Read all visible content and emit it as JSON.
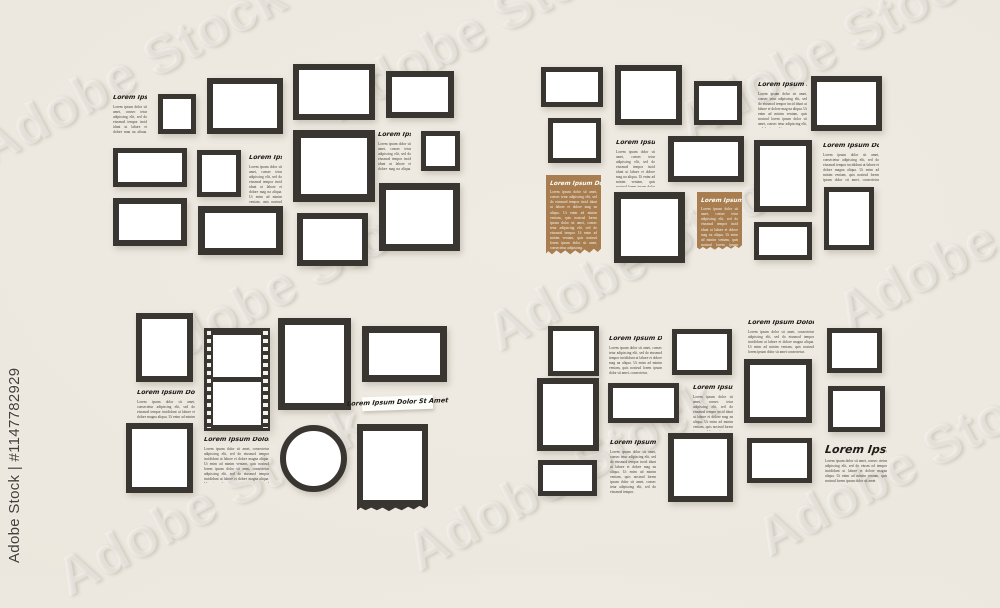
{
  "watermark": {
    "tile_text": "Adobe Stock",
    "side_text": "Adobe Stock | #1147782929"
  },
  "colors": {
    "background": "#ece8df",
    "frame_border": "#393531",
    "frame_fill": "#ffffff",
    "paper_brown": "#a87e50",
    "title_text": "#1f1c18",
    "body_text": "#46423b"
  },
  "captions": {
    "tl1": {
      "title": "Lorem Ipsum Dolor",
      "body": "Lorem ipsum dolor sit amet, consec tetur adipiscing elit, sed do eiusmod tempor incid idunt ut labore et dolore mag na aliqua. Ut enim ad minim veniam, quis nostrud lorem ipsum dolor sit amet, consec tetur adipiscing elit, sed do eiusmod tempor."
    },
    "tl2": {
      "title": "Lorem Ipsum Dolor",
      "body": "Lorem ipsum dolor sit amet, consec tetur adipiscing elit, sed do eiusmod tempor incid idunt ut labore et dolore mag na aliqua. Ut enim ad minim veniam, quis nostrud lorem ipsum dolor sit amet, consec tetur adipiscing elit, sed do eiusmod tempor."
    },
    "tl3": {
      "title": "Lorem Ipsum Dolor",
      "body": "Lorem ipsum dolor sit amet, consec tetur adipiscing elit, sed do eiusmod tempor incid idunt ut labore et dolore mag na aliqua. Ut enim ad minim veniam, quis nostrud lorem ipsum dolor sit amet, consec tetur adipiscing elit, sed do."
    },
    "tr1": {
      "title": "Lorem Ipsum Dolor",
      "body": "Lorem ipsum dolor sit amet, consec tetur adipiscing elit, sed do eiusmod tempor incid idunt ut labore et dolore mag na aliqua. Ut enim ad minim veniam, quis nostrud lorem ipsum dolor sit amet, consec tetur adipiscing elit, sed do eiusmod tempor."
    },
    "tr2": {
      "title": "Lorem Ipsum Dolor",
      "body": "Lorem ipsum dolor sit amet, consec tetur adipiscing elit, sed do eiusmod tempor incid idunt ut labore et dolore mag na aliqua. Ut enim ad minim veniam, quis nostrud lorem ipsum dolor sit amet, consec tetur adipiscing elit, sed do eiusmod tempor."
    },
    "tr3": {
      "title": "Lorem Ipsum Dolor St",
      "body": "Lorem ipsum dolor sit amet, consectetur adipiscing elit, sed do eiusmod tempor incididunt ut labore et dolore magna aliqua. Ut enim ad minim veniam, quis nostrud lorem ipsum dolor sit amet, consectetur adipiscing elit, sed do eiusmod tempor."
    },
    "paper1": {
      "title": "Lorem Ipsum Dolor",
      "body": "Lorem ipsum dolor sit amet, consec tetur adipiscing elit, sed do eiusmod tempor incid idunt ut labore et dolore mag na aliqua. Ut enim ad minim veniam, quis nostrud lorem ipsum dolor sit amet, consec tetur adipiscing elit, sed do eiusmod tempor. Ut enim ad minim veniam, quis nostrud lorem ipsum dolor sit amet, consectetur adipiscing."
    },
    "paper2": {
      "title": "Lorem Ipsum Dolor",
      "body": "Lorem ipsum dolor sit amet, consec tetur adipiscing elit, sed do eiusmod tempor incid idunt ut labore et dolore mag na aliqua. Ut enim ad minim veniam, quis nostrud lorem ipsum dolor sit amet, consec tetur adipiscing elit, sed do eiusmod tempor. Ut enim ad minim veniam."
    },
    "bl1": {
      "title": "Lorem Ipsum Dolor St Amet",
      "body": "Lorem ipsum dolor sit amet, consectetur adipiscing elit, sed do eiusmod tempor incididunt ut labore et dolore magna aliqua. Ut enim ad minim veniam."
    },
    "bl2": {
      "title": "Lorem Ipsum Dolor St Amet",
      "body": "Lorem ipsum dolor sit amet, consectetur adipiscing elit, sed do eiusmod tempor incididunt ut labore et dolore magna aliqua. Ut enim ad minim veniam, quis nostrud lorem ipsum dolor sit amet, consectetur adipiscing elit, sed do eiusmod tempor incididunt ut labore et dolore magna aliqua. Ut enim ad minim veniam, quis nostrud lorem ipsum dolor sit amet, consectetur adipiscing elit, sed do eiusmod tempor."
    },
    "bl_label": {
      "title": "Lorem Ipsum Dolor St Amet"
    },
    "br1": {
      "title": "Lorem Ipsum Dolor",
      "body": "Lorem ipsum dolor sit amet, consec tetur adipiscing elit, sed do eiusmod tempor incididunt ut labore et dolore mag na aliqua. Ut enim ad minim veniam, quis nostrud lorem ipsum dolor sit amet, consectetur."
    },
    "br2": {
      "title": "Lorem Ipsum Dolor St Amet",
      "body": "Lorem ipsum dolor sit amet, consectetur adipiscing elit, sed do eiusmod tempor incididunt ut labore et dolore magna aliqua. Ut enim ad minim veniam, quis nostrud lorem ipsum dolor sit amet consectetur."
    },
    "br3": {
      "title": "Lorem Ipsum Dolor",
      "body": "Lorem ipsum dolor sit amet, consec tetur adipiscing elit, sed do eiusmod tempor incid idunt ut labore et dolore mag na aliqua. Ut enim ad minim veniam, quis nostrud lorem ipsum dolor sit amet, consec tetur adipiscing elit, sed do eiusmod tempor."
    },
    "br4": {
      "title": "Lorem Ipsum Dolor",
      "body": "Lorem ipsum dolor sit amet, consec tetur adipiscing elit, sed do eiusmod tempor incid idunt ut labore et dolore mag na aliqua. Ut enim ad minim veniam, quis nostrud lorem ipsum dolor sit amet, consec tetur adipiscing elit, sed do eiusmod tempor."
    },
    "br5": {
      "title": "Lorem Ipsum Dolor",
      "body": "Lorem ipsum dolor sit amet, consec ctetur adipiscing elit, sed do eiusm od tempor incididunt ut labore et dolore magna aliqua. Ut enim ad minim veniam, quis nostrud lorem ipsum dolor sit amet"
    }
  }
}
